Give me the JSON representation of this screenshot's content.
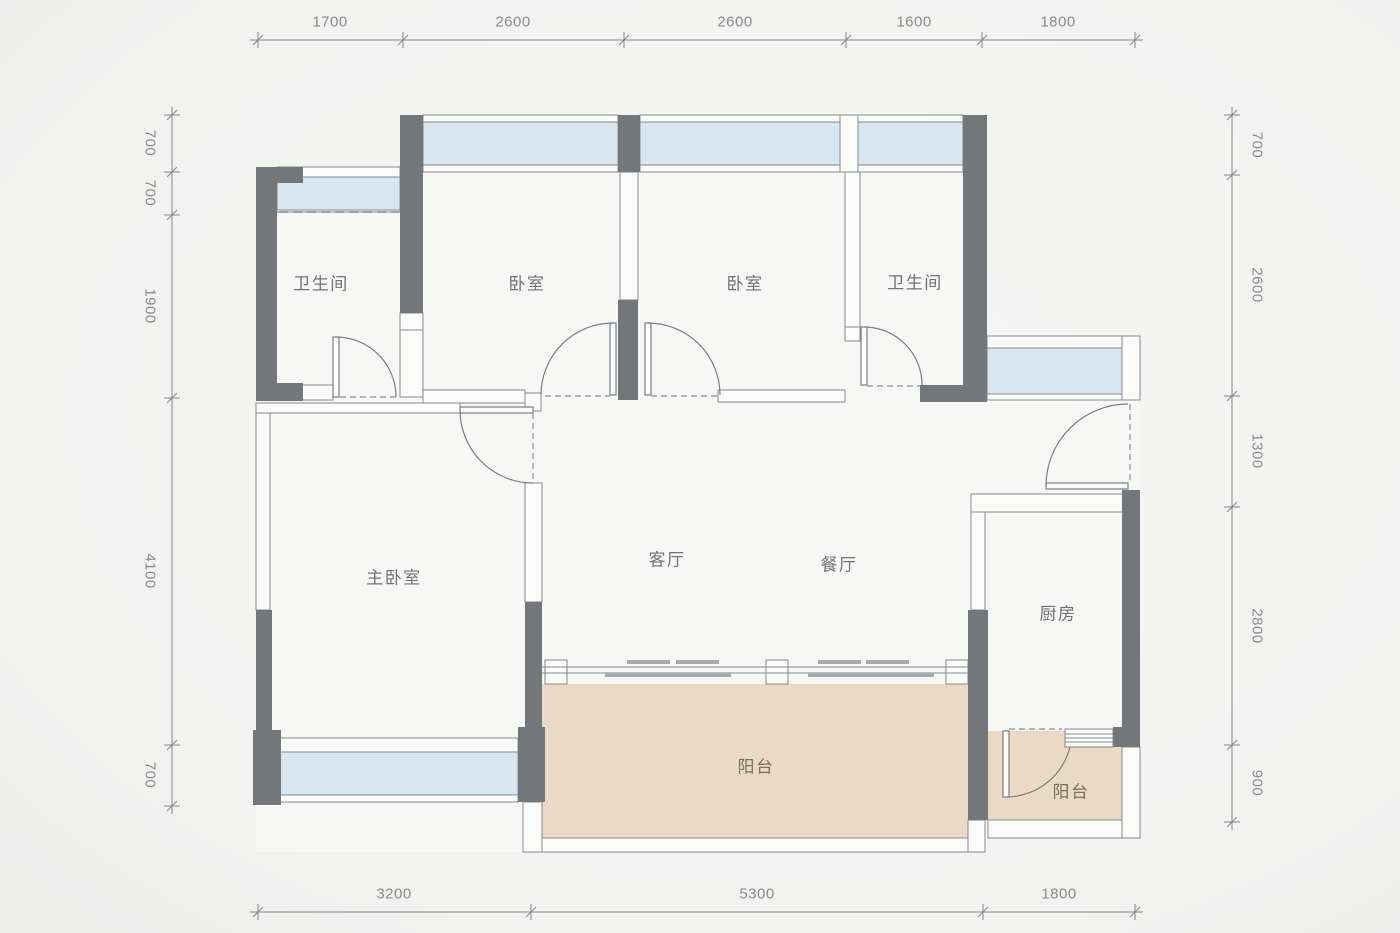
{
  "plan_title": "4室2厅2卫 户型图",
  "rooms": {
    "bathroom_top_left": {
      "label": "卫生间"
    },
    "bedroom_left": {
      "label": "卧室"
    },
    "bedroom_right": {
      "label": "卧室"
    },
    "bathroom_top_right": {
      "label": "卫生间"
    },
    "master_bedroom": {
      "label": "主卧室"
    },
    "living_room": {
      "label": "客厅"
    },
    "dining_room": {
      "label": "餐厅"
    },
    "kitchen": {
      "label": "厨房"
    },
    "balcony_main": {
      "label": "阳台"
    },
    "balcony_small": {
      "label": "阳台"
    }
  },
  "dimensions": {
    "top": [
      "1700",
      "2600",
      "2600",
      "1600",
      "1800"
    ],
    "bottom": [
      "3200",
      "5300",
      "1800"
    ],
    "left": [
      "700",
      "700",
      "1900",
      "4100",
      "700"
    ],
    "right": [
      "700",
      "2600",
      "1300",
      "2800",
      "900"
    ]
  },
  "colors": {
    "wall": "#74777a",
    "window_fill": "#d9e6ef",
    "balcony_fill": "#ead9c4",
    "floor_fill": "#f7f7f5",
    "background": "#f2f2f1",
    "line": "#85898d",
    "dimension_text": "#8b8b8b",
    "room_text": "#6f7377"
  }
}
